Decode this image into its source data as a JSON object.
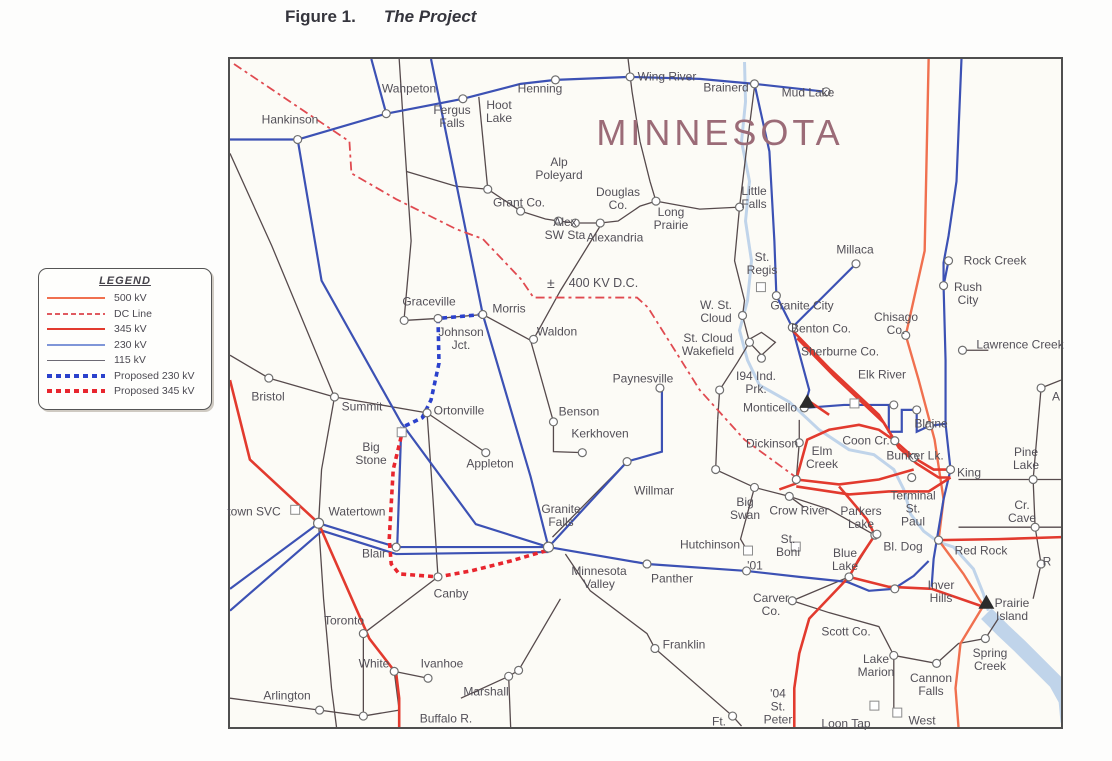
{
  "figure": {
    "label": "Figure 1.",
    "title": "The Project"
  },
  "legend": {
    "title": "LEGEND",
    "items": [
      {
        "label": "500 kV",
        "color": "#f0704f",
        "style": "solid",
        "weight": 2
      },
      {
        "label": "DC Line",
        "color": "#e05a60",
        "style": "dashed",
        "weight": 2
      },
      {
        "label": "345 kV",
        "color": "#e23a2e",
        "style": "solid",
        "weight": 2
      },
      {
        "label": "230 kV",
        "color": "#7f96d8",
        "style": "solid",
        "weight": 2
      },
      {
        "label": "115 kV",
        "color": "#6d6a74",
        "style": "solid",
        "weight": 1
      },
      {
        "label": "Proposed 230 kV",
        "color": "#2b41cc",
        "style": "dotted",
        "weight": 4
      },
      {
        "label": "Proposed 345 kV",
        "color": "#e8262e",
        "style": "dotted",
        "weight": 4
      }
    ]
  },
  "map": {
    "state_label": "MINNESOTA",
    "dc_symbol": "±",
    "dc_label": "400 KV D.C.",
    "colors": {
      "river": "#b9cfe9",
      "labels": "#535058",
      "state_label": "#9b6b77"
    },
    "places": [
      {
        "n": "Wahpeton",
        "x": 409,
        "y": 89
      },
      {
        "n": "Hankinson",
        "x": 290,
        "y": 120
      },
      {
        "n": "Fergus\nFalls",
        "x": 452,
        "y": 117
      },
      {
        "n": "Hoot\nLake",
        "x": 499,
        "y": 112
      },
      {
        "n": "Henning",
        "x": 540,
        "y": 89
      },
      {
        "n": "Wing River",
        "x": 667,
        "y": 77
      },
      {
        "n": "Brainerd",
        "x": 726,
        "y": 88
      },
      {
        "n": "Mud Lake",
        "x": 808,
        "y": 93
      },
      {
        "n": "Alp\nPoleyard",
        "x": 559,
        "y": 169
      },
      {
        "n": "Grant Co.",
        "x": 519,
        "y": 203
      },
      {
        "n": "Douglas\nCo.",
        "x": 618,
        "y": 199
      },
      {
        "n": "Alex\nSW Sta",
        "x": 565,
        "y": 229
      },
      {
        "n": "Alexandria",
        "x": 615,
        "y": 238
      },
      {
        "n": "Long\nPrairie",
        "x": 671,
        "y": 219
      },
      {
        "n": "Little\nFalls",
        "x": 754,
        "y": 198
      },
      {
        "n": "Millaca",
        "x": 855,
        "y": 250
      },
      {
        "n": "Rock Creek",
        "x": 995,
        "y": 261
      },
      {
        "n": "Rush\nCity",
        "x": 968,
        "y": 294
      },
      {
        "n": "Chisago\nCo.",
        "x": 896,
        "y": 324
      },
      {
        "n": "Lawrence Creek",
        "x": 1020,
        "y": 345
      },
      {
        "n": "St.\nRegis",
        "x": 762,
        "y": 264
      },
      {
        "n": "Granite City",
        "x": 802,
        "y": 306
      },
      {
        "n": "W. St.\nCloud",
        "x": 716,
        "y": 312
      },
      {
        "n": "Benton Co.",
        "x": 821,
        "y": 329
      },
      {
        "n": "St. Cloud\nWakefield",
        "x": 708,
        "y": 345
      },
      {
        "n": "Sherburne Co.",
        "x": 840,
        "y": 352
      },
      {
        "n": "Elk River",
        "x": 882,
        "y": 375
      },
      {
        "n": "I94 Ind.\nPrk.",
        "x": 756,
        "y": 383
      },
      {
        "n": "Monticello",
        "x": 770,
        "y": 408
      },
      {
        "n": "Graceville",
        "x": 429,
        "y": 302
      },
      {
        "n": "Morris",
        "x": 509,
        "y": 309
      },
      {
        "n": "Johnson\nJct.",
        "x": 461,
        "y": 339
      },
      {
        "n": "Waldon",
        "x": 557,
        "y": 332
      },
      {
        "n": "Bristol",
        "x": 268,
        "y": 397
      },
      {
        "n": "Summit",
        "x": 362,
        "y": 407
      },
      {
        "n": "Ortonville",
        "x": 459,
        "y": 411
      },
      {
        "n": "Big\nStone",
        "x": 371,
        "y": 454
      },
      {
        "n": "Appleton",
        "x": 490,
        "y": 464
      },
      {
        "n": "Paynesville",
        "x": 643,
        "y": 379
      },
      {
        "n": "Benson",
        "x": 579,
        "y": 412
      },
      {
        "n": "Kerkhoven",
        "x": 600,
        "y": 434
      },
      {
        "n": "Willmar",
        "x": 654,
        "y": 491
      },
      {
        "n": "Granite\nFalls",
        "x": 561,
        "y": 516
      },
      {
        "n": "Minnesota\nValley",
        "x": 599,
        "y": 578
      },
      {
        "n": "Panther",
        "x": 672,
        "y": 579
      },
      {
        "n": "Hutchinson",
        "x": 710,
        "y": 545
      },
      {
        "n": "'01",
        "x": 755,
        "y": 566
      },
      {
        "n": "Dickinson",
        "x": 772,
        "y": 444
      },
      {
        "n": "Big\nSwan",
        "x": 745,
        "y": 509
      },
      {
        "n": "Crow River",
        "x": 799,
        "y": 511
      },
      {
        "n": "St.\nBoni",
        "x": 788,
        "y": 546
      },
      {
        "n": "Carver\nCo.",
        "x": 771,
        "y": 605
      },
      {
        "n": "Scott Co.",
        "x": 846,
        "y": 632
      },
      {
        "n": "Franklin",
        "x": 684,
        "y": 645
      },
      {
        "n": "Ft.",
        "x": 719,
        "y": 722
      },
      {
        "n": "'04\nSt.\nPeter",
        "x": 778,
        "y": 707
      },
      {
        "n": "Loon Tap",
        "x": 846,
        "y": 724
      },
      {
        "n": "West",
        "x": 922,
        "y": 721
      },
      {
        "n": "Lake\nMarion",
        "x": 876,
        "y": 666
      },
      {
        "n": "Cannon\nFalls",
        "x": 931,
        "y": 685
      },
      {
        "n": "Spring\nCreek",
        "x": 990,
        "y": 660
      },
      {
        "n": "Prairie\nIsland",
        "x": 1012,
        "y": 610
      },
      {
        "n": "Inver\nHills",
        "x": 941,
        "y": 592
      },
      {
        "n": "Red Rock",
        "x": 981,
        "y": 551
      },
      {
        "n": "Bl. Dog",
        "x": 903,
        "y": 547
      },
      {
        "n": "Blue\nLake",
        "x": 845,
        "y": 560
      },
      {
        "n": "Parkers\nLake",
        "x": 861,
        "y": 518
      },
      {
        "n": "Terminal\nSt.\nPaul",
        "x": 913,
        "y": 509
      },
      {
        "n": "King",
        "x": 969,
        "y": 473
      },
      {
        "n": "Coon Cr.",
        "x": 866,
        "y": 441
      },
      {
        "n": "Blaine",
        "x": 931,
        "y": 424
      },
      {
        "n": "Bunker Lk.",
        "x": 915,
        "y": 456
      },
      {
        "n": "Elm\nCreek",
        "x": 822,
        "y": 458
      },
      {
        "n": "Pine\nLake",
        "x": 1026,
        "y": 459
      },
      {
        "n": "Cr.\nCave",
        "x": 1022,
        "y": 512
      },
      {
        "n": "town SVC",
        "x": 254,
        "y": 512
      },
      {
        "n": "Watertown",
        "x": 357,
        "y": 512
      },
      {
        "n": "Blair",
        "x": 374,
        "y": 554
      },
      {
        "n": "Canby",
        "x": 451,
        "y": 594
      },
      {
        "n": "Toronto",
        "x": 344,
        "y": 621
      },
      {
        "n": "White",
        "x": 374,
        "y": 664
      },
      {
        "n": "Ivanhoe",
        "x": 442,
        "y": 664
      },
      {
        "n": "Arlington",
        "x": 287,
        "y": 696
      },
      {
        "n": "Marshall",
        "x": 486,
        "y": 692
      },
      {
        "n": "Buffalo R.",
        "x": 446,
        "y": 719
      },
      {
        "n": "A",
        "x": 1056,
        "y": 397
      },
      {
        "n": "R",
        "x": 1047,
        "y": 562
      }
    ]
  }
}
